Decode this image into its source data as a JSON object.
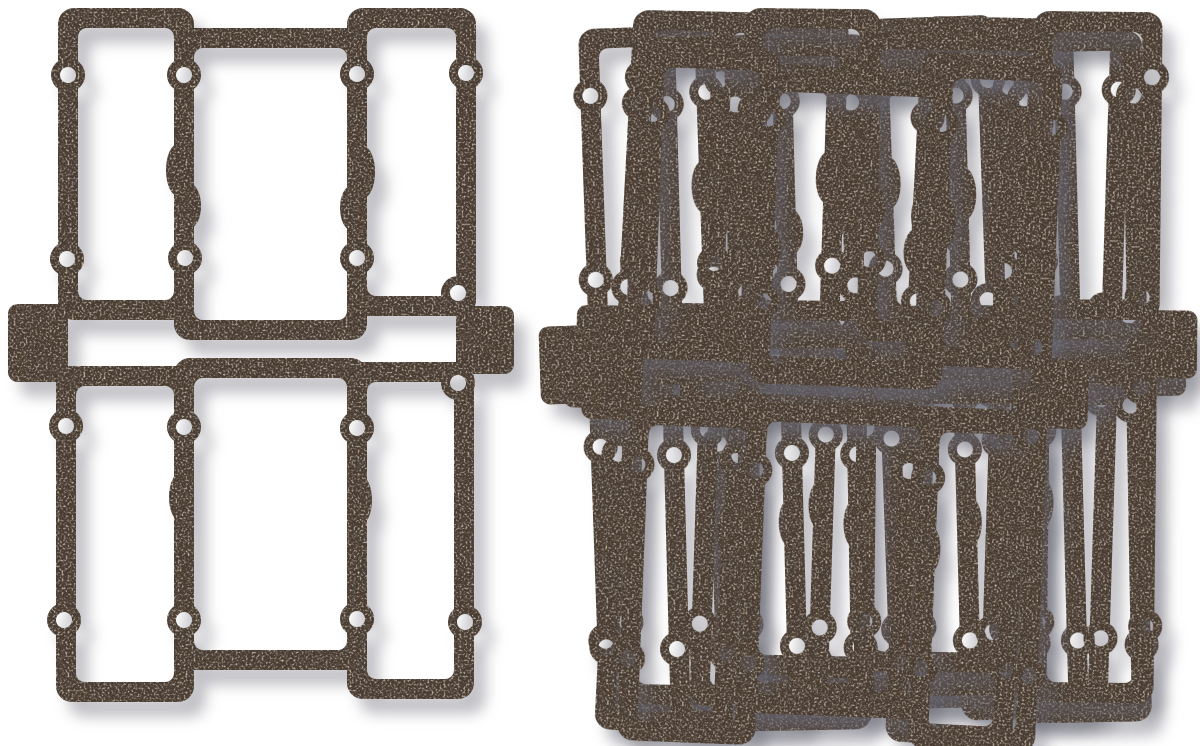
{
  "meta": {
    "type": "product-photo",
    "description": "A set of dark brown die-cut motorcycle valve cover gaskets on a white background: one gasket laid flat on the left and a fanned, overlapping stack of identical gaskets on the right.",
    "background_color": "#ffffff"
  },
  "colors": {
    "gasket_base": "#4a3d36",
    "speckle": "#c9b396",
    "mottle_dark": "#140c07",
    "shadow": "rgba(100,100,112,0.40)"
  },
  "gasket": {
    "strip_width": 20,
    "outer_corner_radius": 16,
    "inner_corner_radius": 9,
    "cells": [
      [
        68,
        18,
        184,
        310
      ],
      [
        184,
        38,
        357,
        330
      ],
      [
        357,
        18,
        466,
        306
      ],
      [
        66,
        376,
        184,
        692
      ],
      [
        184,
        368,
        357,
        660
      ],
      [
        357,
        372,
        464,
        689
      ]
    ],
    "tabs": [
      [
        8,
        304,
        60,
        78,
        10
      ],
      [
        456,
        306,
        58,
        68,
        10
      ]
    ],
    "bolt_holes": [
      [
        68,
        75
      ],
      [
        184,
        75
      ],
      [
        357,
        74
      ],
      [
        466,
        73
      ],
      [
        67,
        259
      ],
      [
        185,
        258
      ],
      [
        357,
        258
      ],
      [
        458,
        293
      ],
      [
        66,
        426
      ],
      [
        184,
        427
      ],
      [
        357,
        428
      ],
      [
        458,
        383
      ],
      [
        64,
        620
      ],
      [
        184,
        620
      ],
      [
        357,
        619
      ],
      [
        465,
        622
      ]
    ],
    "hole_radius": 8,
    "bulge_radius": 17,
    "wiggles": [
      [
        178,
        170,
        12,
        26
      ],
      [
        190,
        206,
        11,
        22
      ],
      [
        180,
        497,
        11,
        24
      ],
      [
        363,
        172,
        12,
        26
      ],
      [
        351,
        208,
        11,
        22
      ],
      [
        361,
        500,
        11,
        24
      ]
    ]
  },
  "layout": {
    "canvas": [
      1200,
      746
    ],
    "single_gasket": [
      0,
      0,
      0
    ],
    "stack": [
      [
        532,
        14,
        -2.0
      ],
      [
        568,
        6,
        1.2
      ],
      [
        606,
        24,
        -1.5
      ],
      [
        644,
        10,
        1.8
      ],
      [
        672,
        26,
        -1.0
      ],
      [
        683,
        2,
        0.6
      ],
      [
        556,
        38,
        3.0
      ],
      [
        574,
        46,
        2.2
      ]
    ]
  },
  "shadow": {
    "dx": 12,
    "dy": 15,
    "blur": 7
  }
}
